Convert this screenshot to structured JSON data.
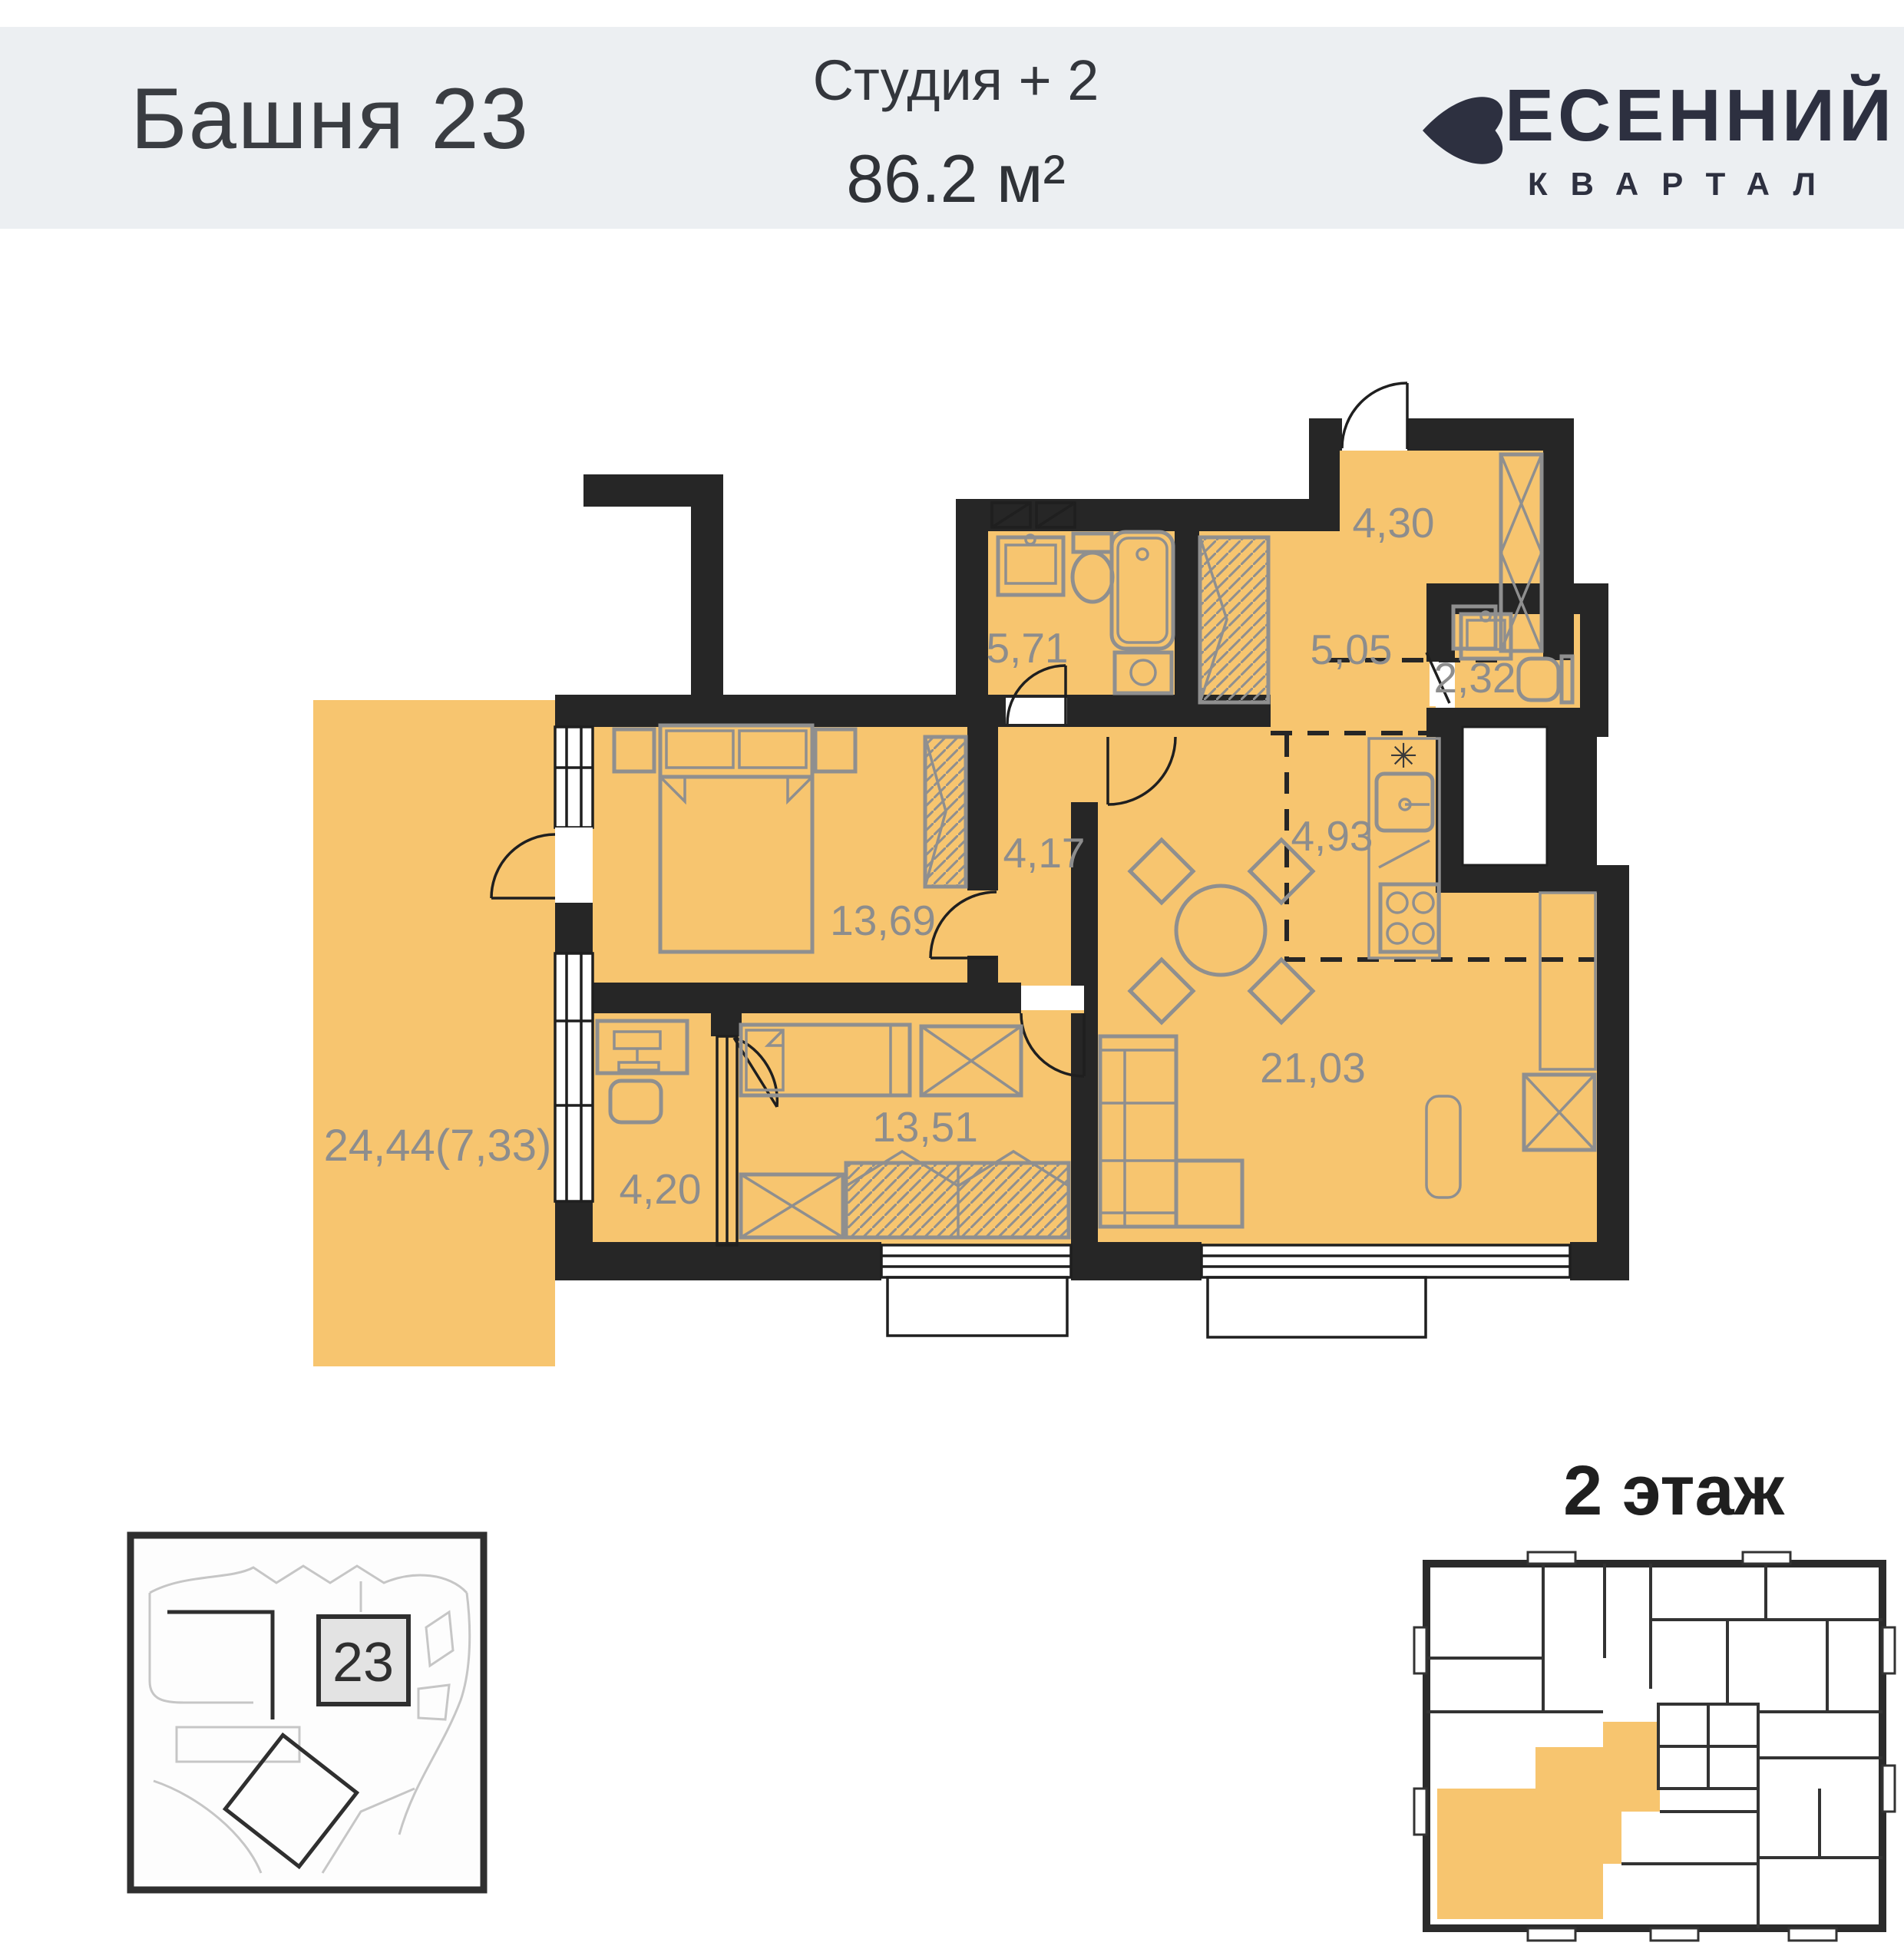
{
  "header": {
    "building_title": "Башня 23",
    "unit_type": "Студия + 2",
    "unit_area": "86.2 м²",
    "brand": {
      "line1": "ЕСЕННИЙ",
      "line2": "КВАРТАЛ"
    }
  },
  "floor_plan": {
    "rooms": [
      {
        "id": "entry-hall",
        "area_label": "4,30"
      },
      {
        "id": "bathroom",
        "area_label": "5,71"
      },
      {
        "id": "corridor",
        "area_label": "5,05"
      },
      {
        "id": "wc",
        "area_label": "2,32"
      },
      {
        "id": "inner-hall",
        "area_label": "4,17"
      },
      {
        "id": "kitchen-zone",
        "area_label": "4,93"
      },
      {
        "id": "bedroom",
        "area_label": "13,69"
      },
      {
        "id": "living-room",
        "area_label": "21,03"
      },
      {
        "id": "kids-room",
        "area_label": "13,51"
      },
      {
        "id": "study",
        "area_label": "4,20"
      },
      {
        "id": "terrace",
        "area_label": "24,44(7,33)"
      }
    ],
    "symbols": {
      "kitchen_vent": "✳"
    }
  },
  "site_map": {
    "building_badge": "23"
  },
  "floor_indicator": {
    "label": "2 этаж"
  },
  "colors": {
    "room_fill": "#F7C56F",
    "wall": "#262626",
    "header_band": "#ECEFF2",
    "label_gray": "#8D8D8D",
    "brand_navy": "#2D3040"
  }
}
